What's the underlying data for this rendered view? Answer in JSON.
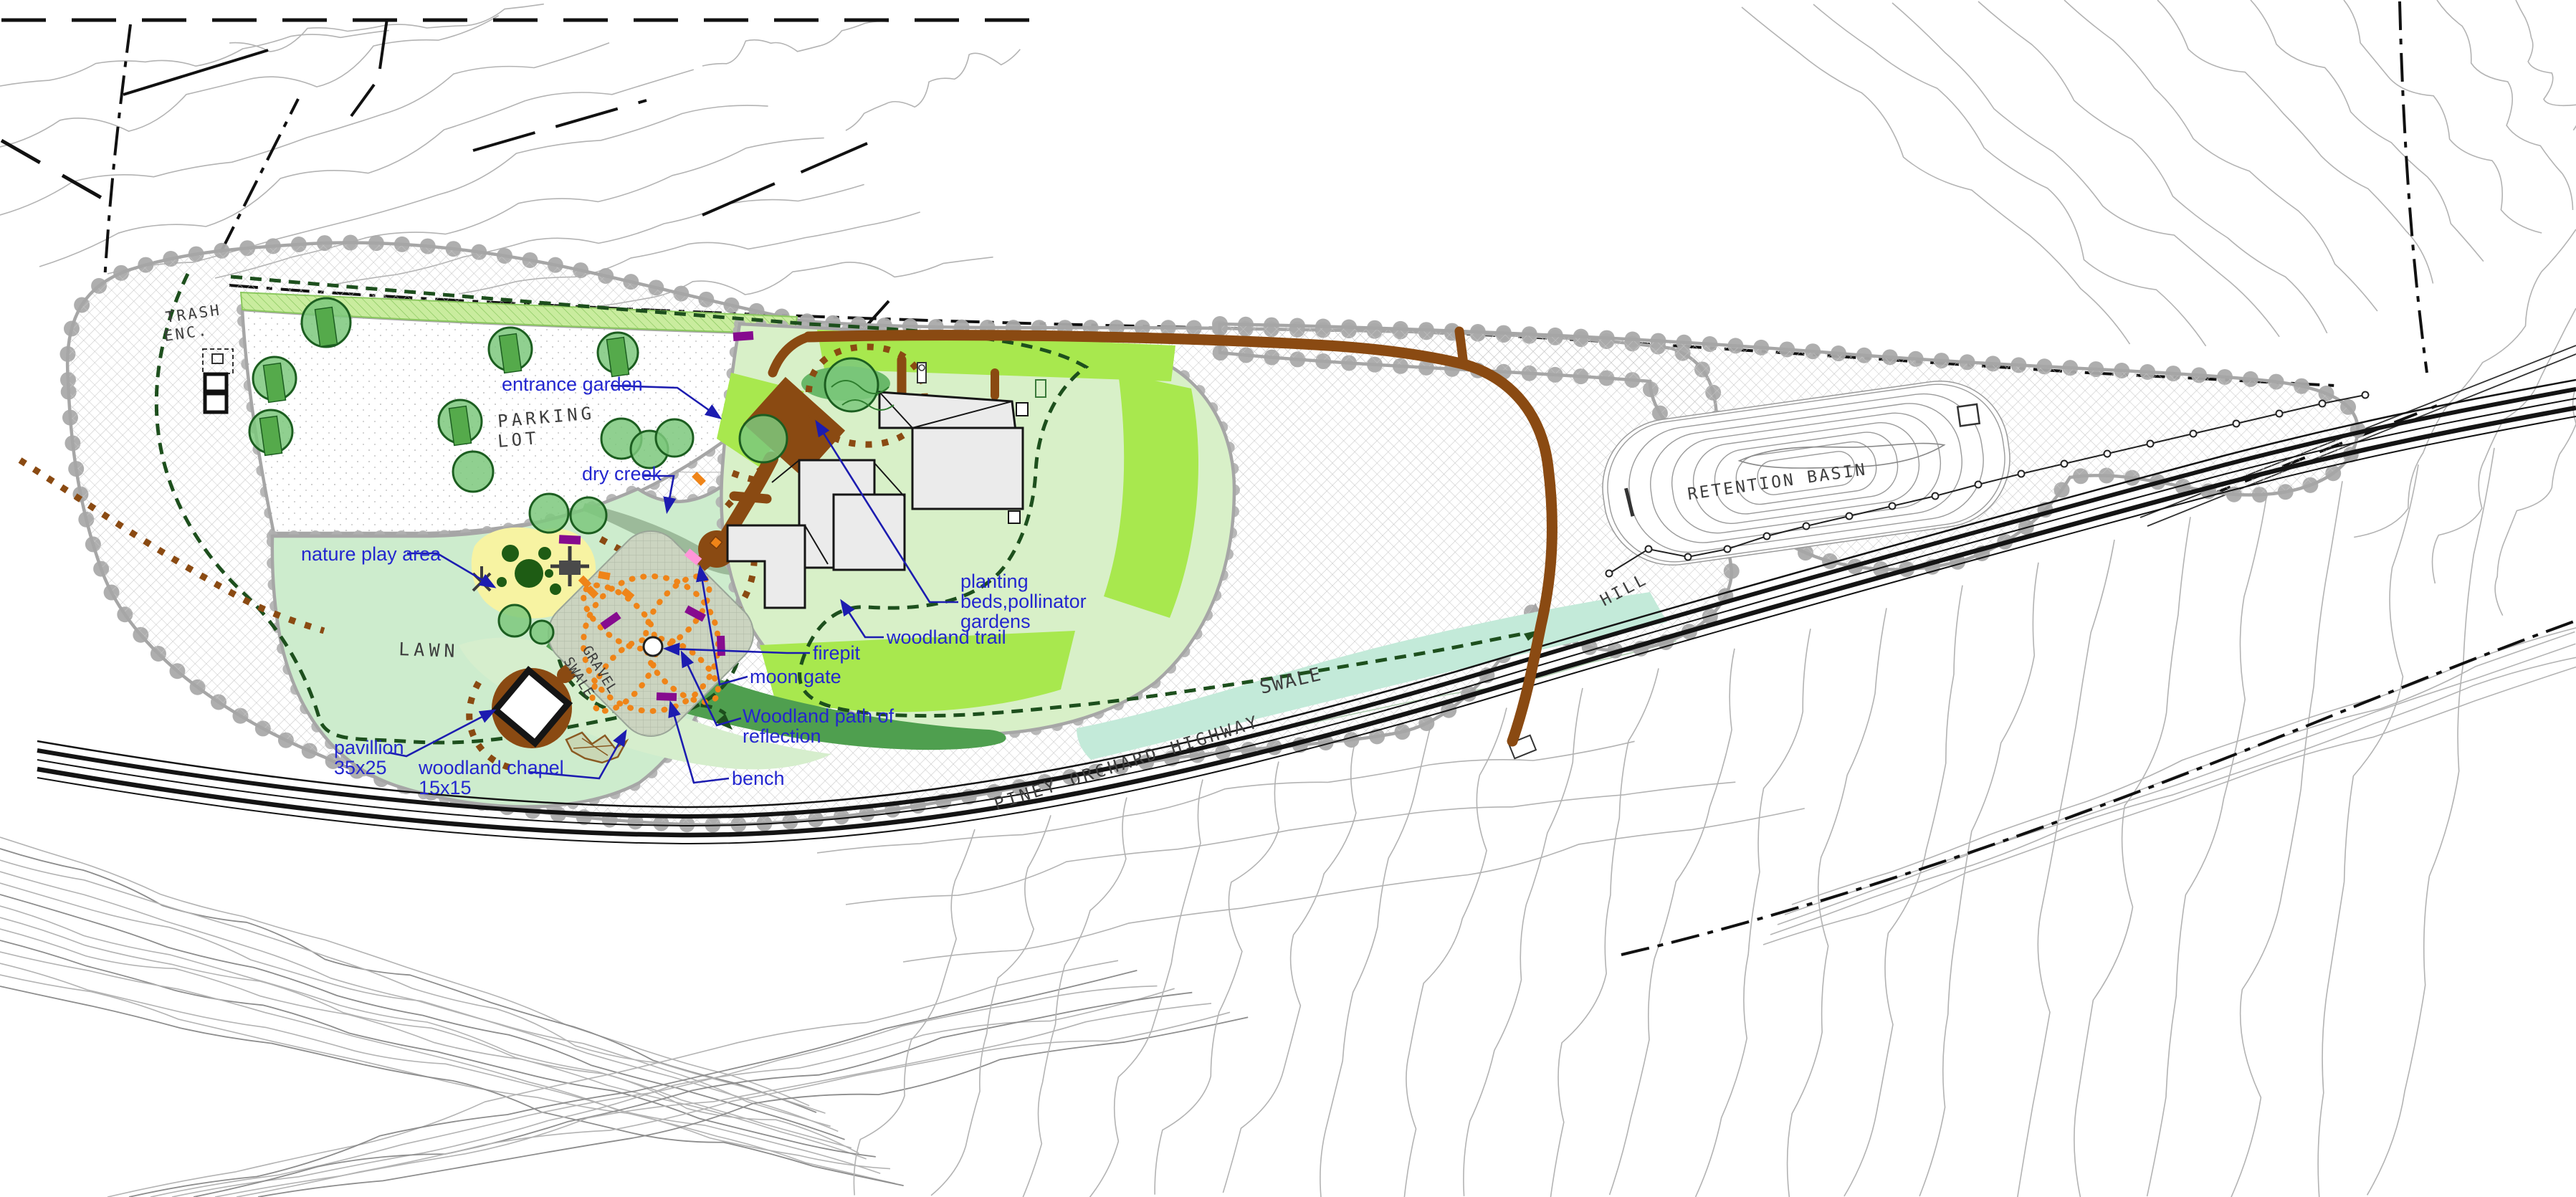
{
  "plan_labels": {
    "entrance_garden": "entrance garden",
    "dry_creek": "dry creek",
    "nature_play_area": "nature play area",
    "planting_line1": "planting",
    "planting_line2": "beds,pollinator",
    "planting_line3": "gardens",
    "woodland_trail": "woodland trail",
    "firepit": "firepit",
    "moon_gate": "moon gate",
    "woodland_path_line1": "Woodland path of",
    "woodland_path_line2": "reflection",
    "bench": "bench",
    "pavillion_line1": "pavillion",
    "pavillion_line2": "35x25",
    "chapel_line1": "woodland chapel",
    "chapel_line2": "15x15"
  },
  "site_labels": {
    "trash_line1": "TRASH",
    "trash_line2": "ENC.",
    "parking_line1": "PARKING",
    "parking_line2": "LOT",
    "lawn": "LAWN",
    "retention_basin": "RETENTION BASIN",
    "hill": "HILL",
    "swale": "SWALE",
    "gravel_word": "GRAVEL",
    "gravel_swale_word": "SWALE",
    "highway": "PINEY ORCHARD HIGHWAY"
  },
  "colors": {
    "label_blue": "#2326cf",
    "leader_blue": "#1c1cb0",
    "trail_green": "#1d4f1d",
    "path_brown": "#8a4a12",
    "bench_purple": "#860b8f",
    "accent_orange": "#ef8418",
    "moon_gate_pink": "#ff96d9",
    "lawn_green": "#cdeccd",
    "bed_green": "#a8e84e",
    "swale_green": "#c3ead9",
    "play_yellow": "#f7f3a2",
    "tree_green": "#7cc87c",
    "canopy_gray": "#a9a9a9",
    "building_gray": "#ebebeb"
  }
}
